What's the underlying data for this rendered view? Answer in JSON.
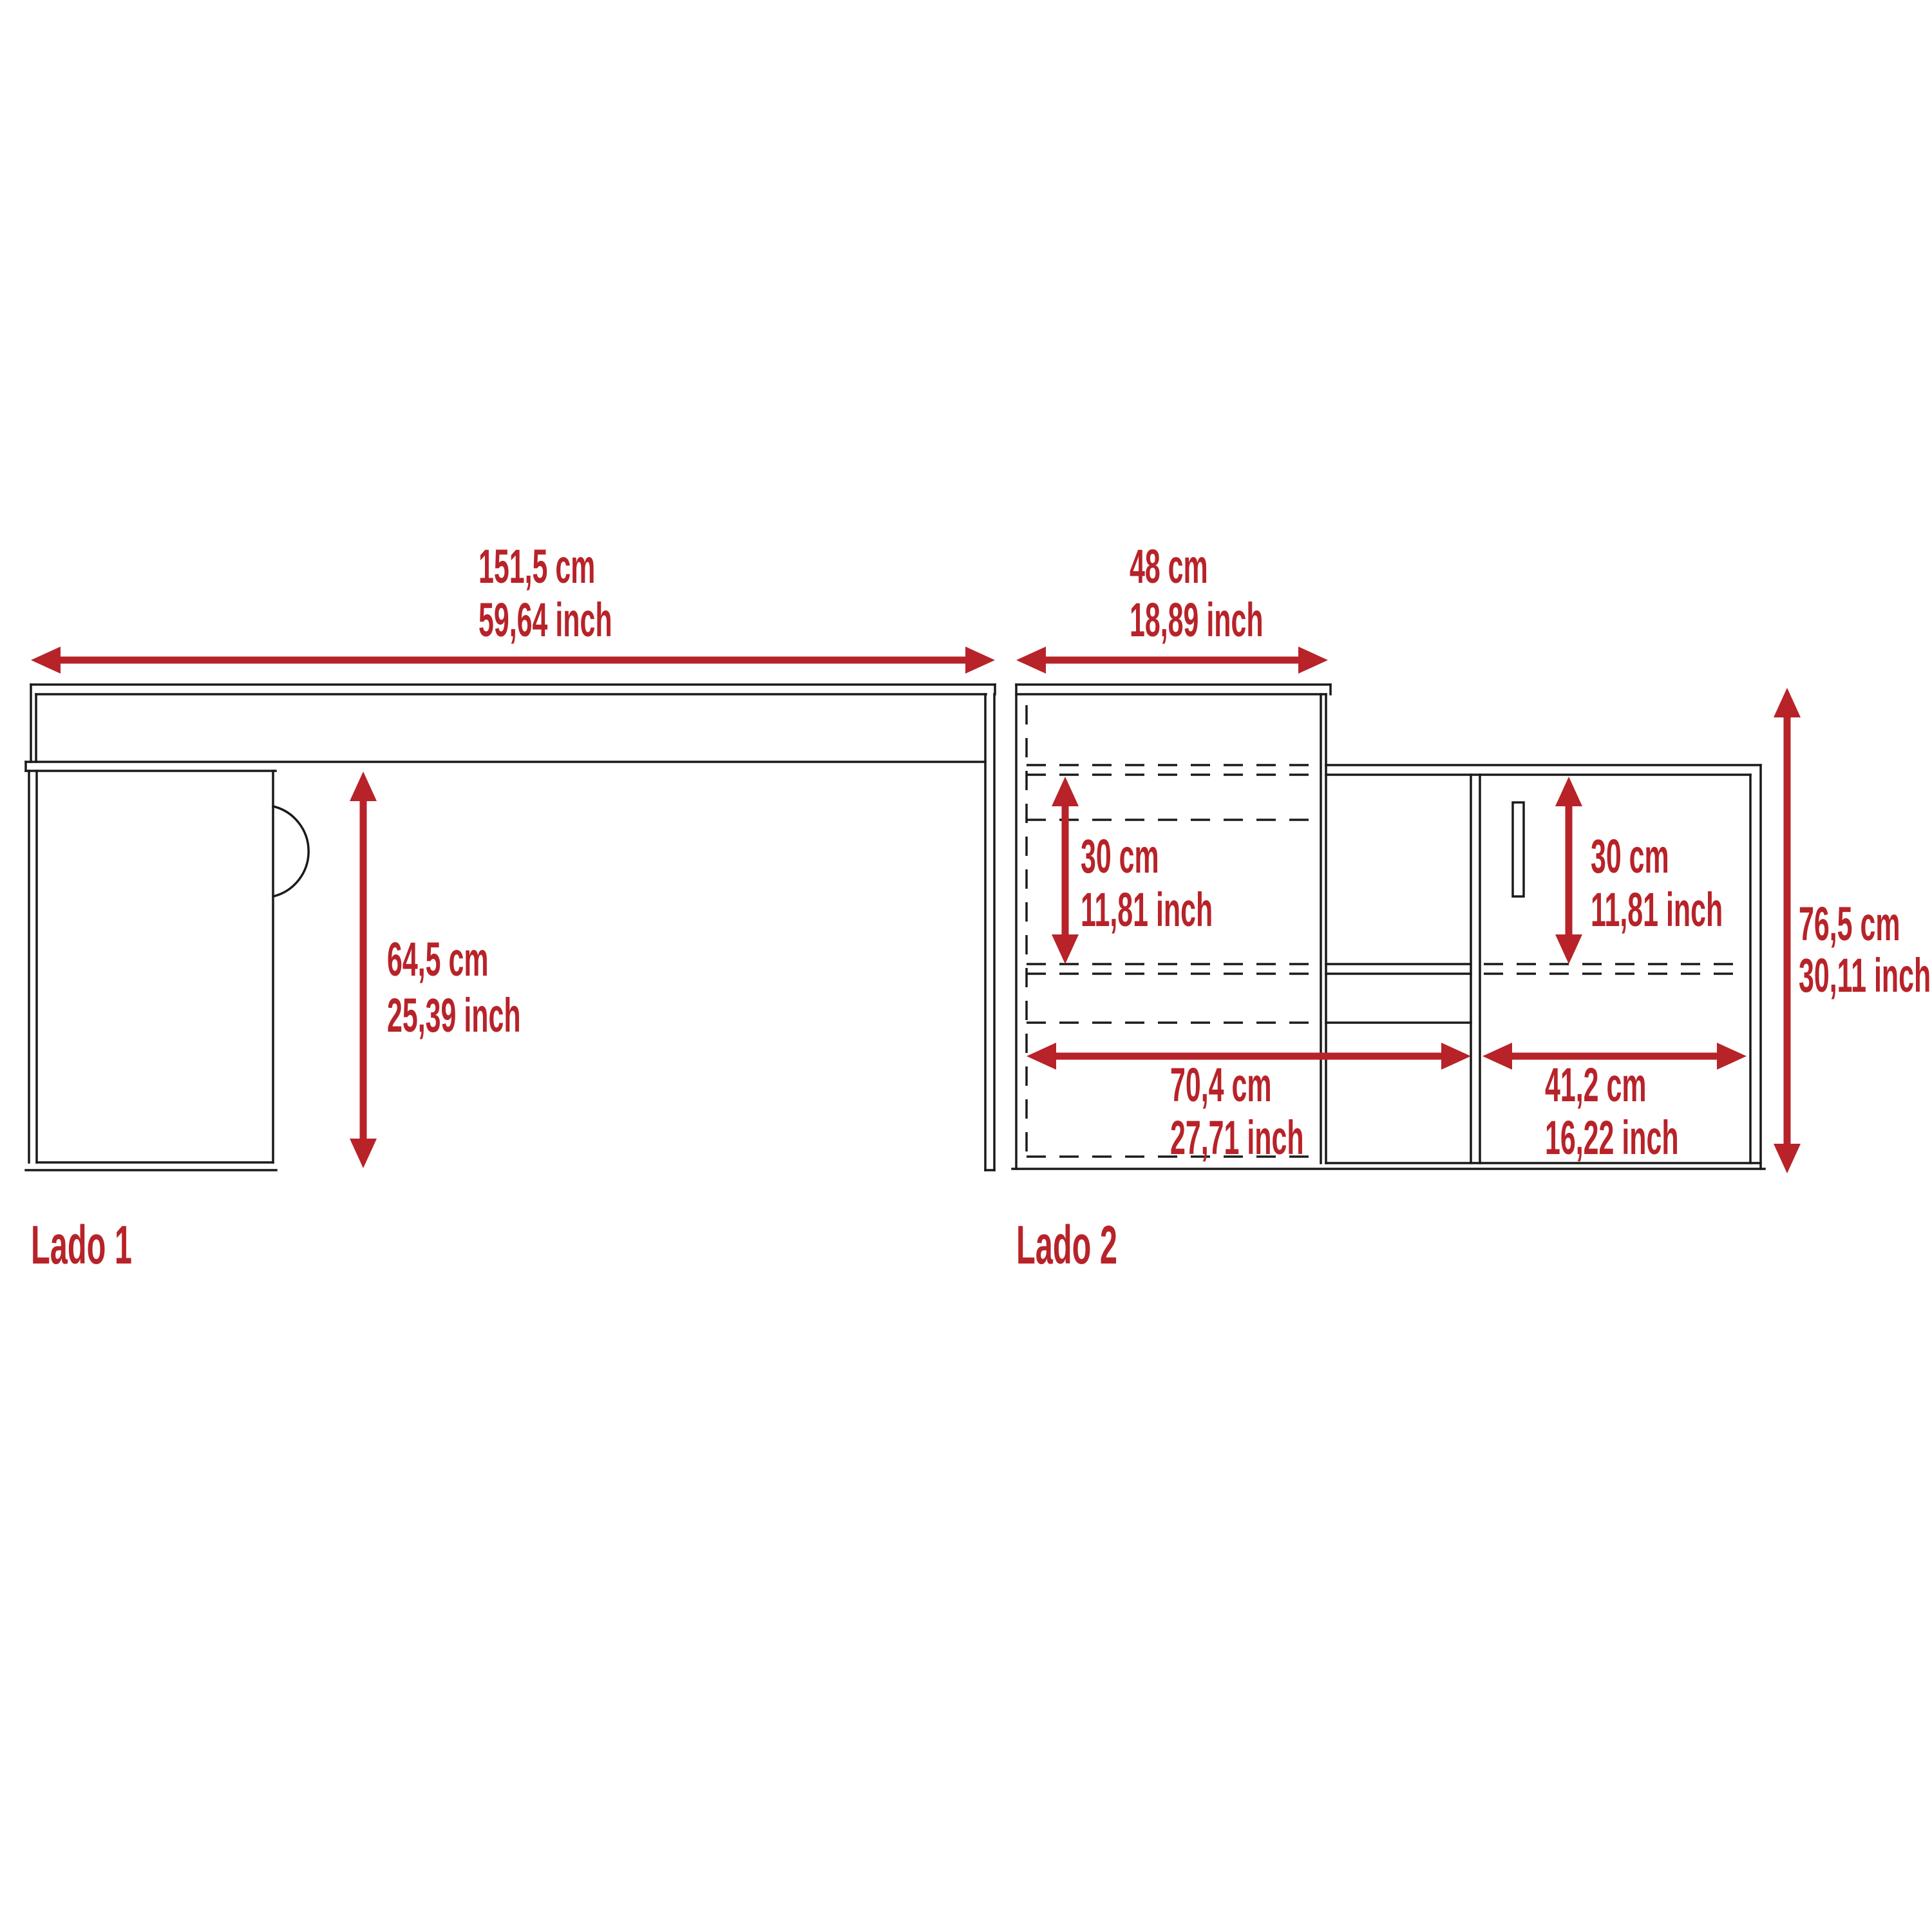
{
  "diagram": {
    "accent_color": "#B72329",
    "line_color": "#1A1A1A",
    "background_color": "#FFFFFF",
    "side1": {
      "label": "Lado 1",
      "dimensions": {
        "width": {
          "cm": "151,5 cm",
          "inch": "59,64 inch"
        },
        "underdesk_height": {
          "cm": "64,5 cm",
          "inch": "25,39 inch"
        }
      }
    },
    "side2": {
      "label": "Lado 2",
      "dimensions": {
        "hutch_width": {
          "cm": "48 cm",
          "inch": "18,89 inch"
        },
        "left_compartment_height": {
          "cm": "30 cm",
          "inch": "11,81 inch"
        },
        "door_compartment_height": {
          "cm": "30 cm",
          "inch": "11,81 inch"
        },
        "total_height": {
          "cm": "76,5 cm",
          "inch": "30,11 inch"
        },
        "left_section_width": {
          "cm": "70,4 cm",
          "inch": "27,71 inch"
        },
        "door_section_width": {
          "cm": "41,2 cm",
          "inch": "16,22 inch"
        }
      }
    }
  }
}
